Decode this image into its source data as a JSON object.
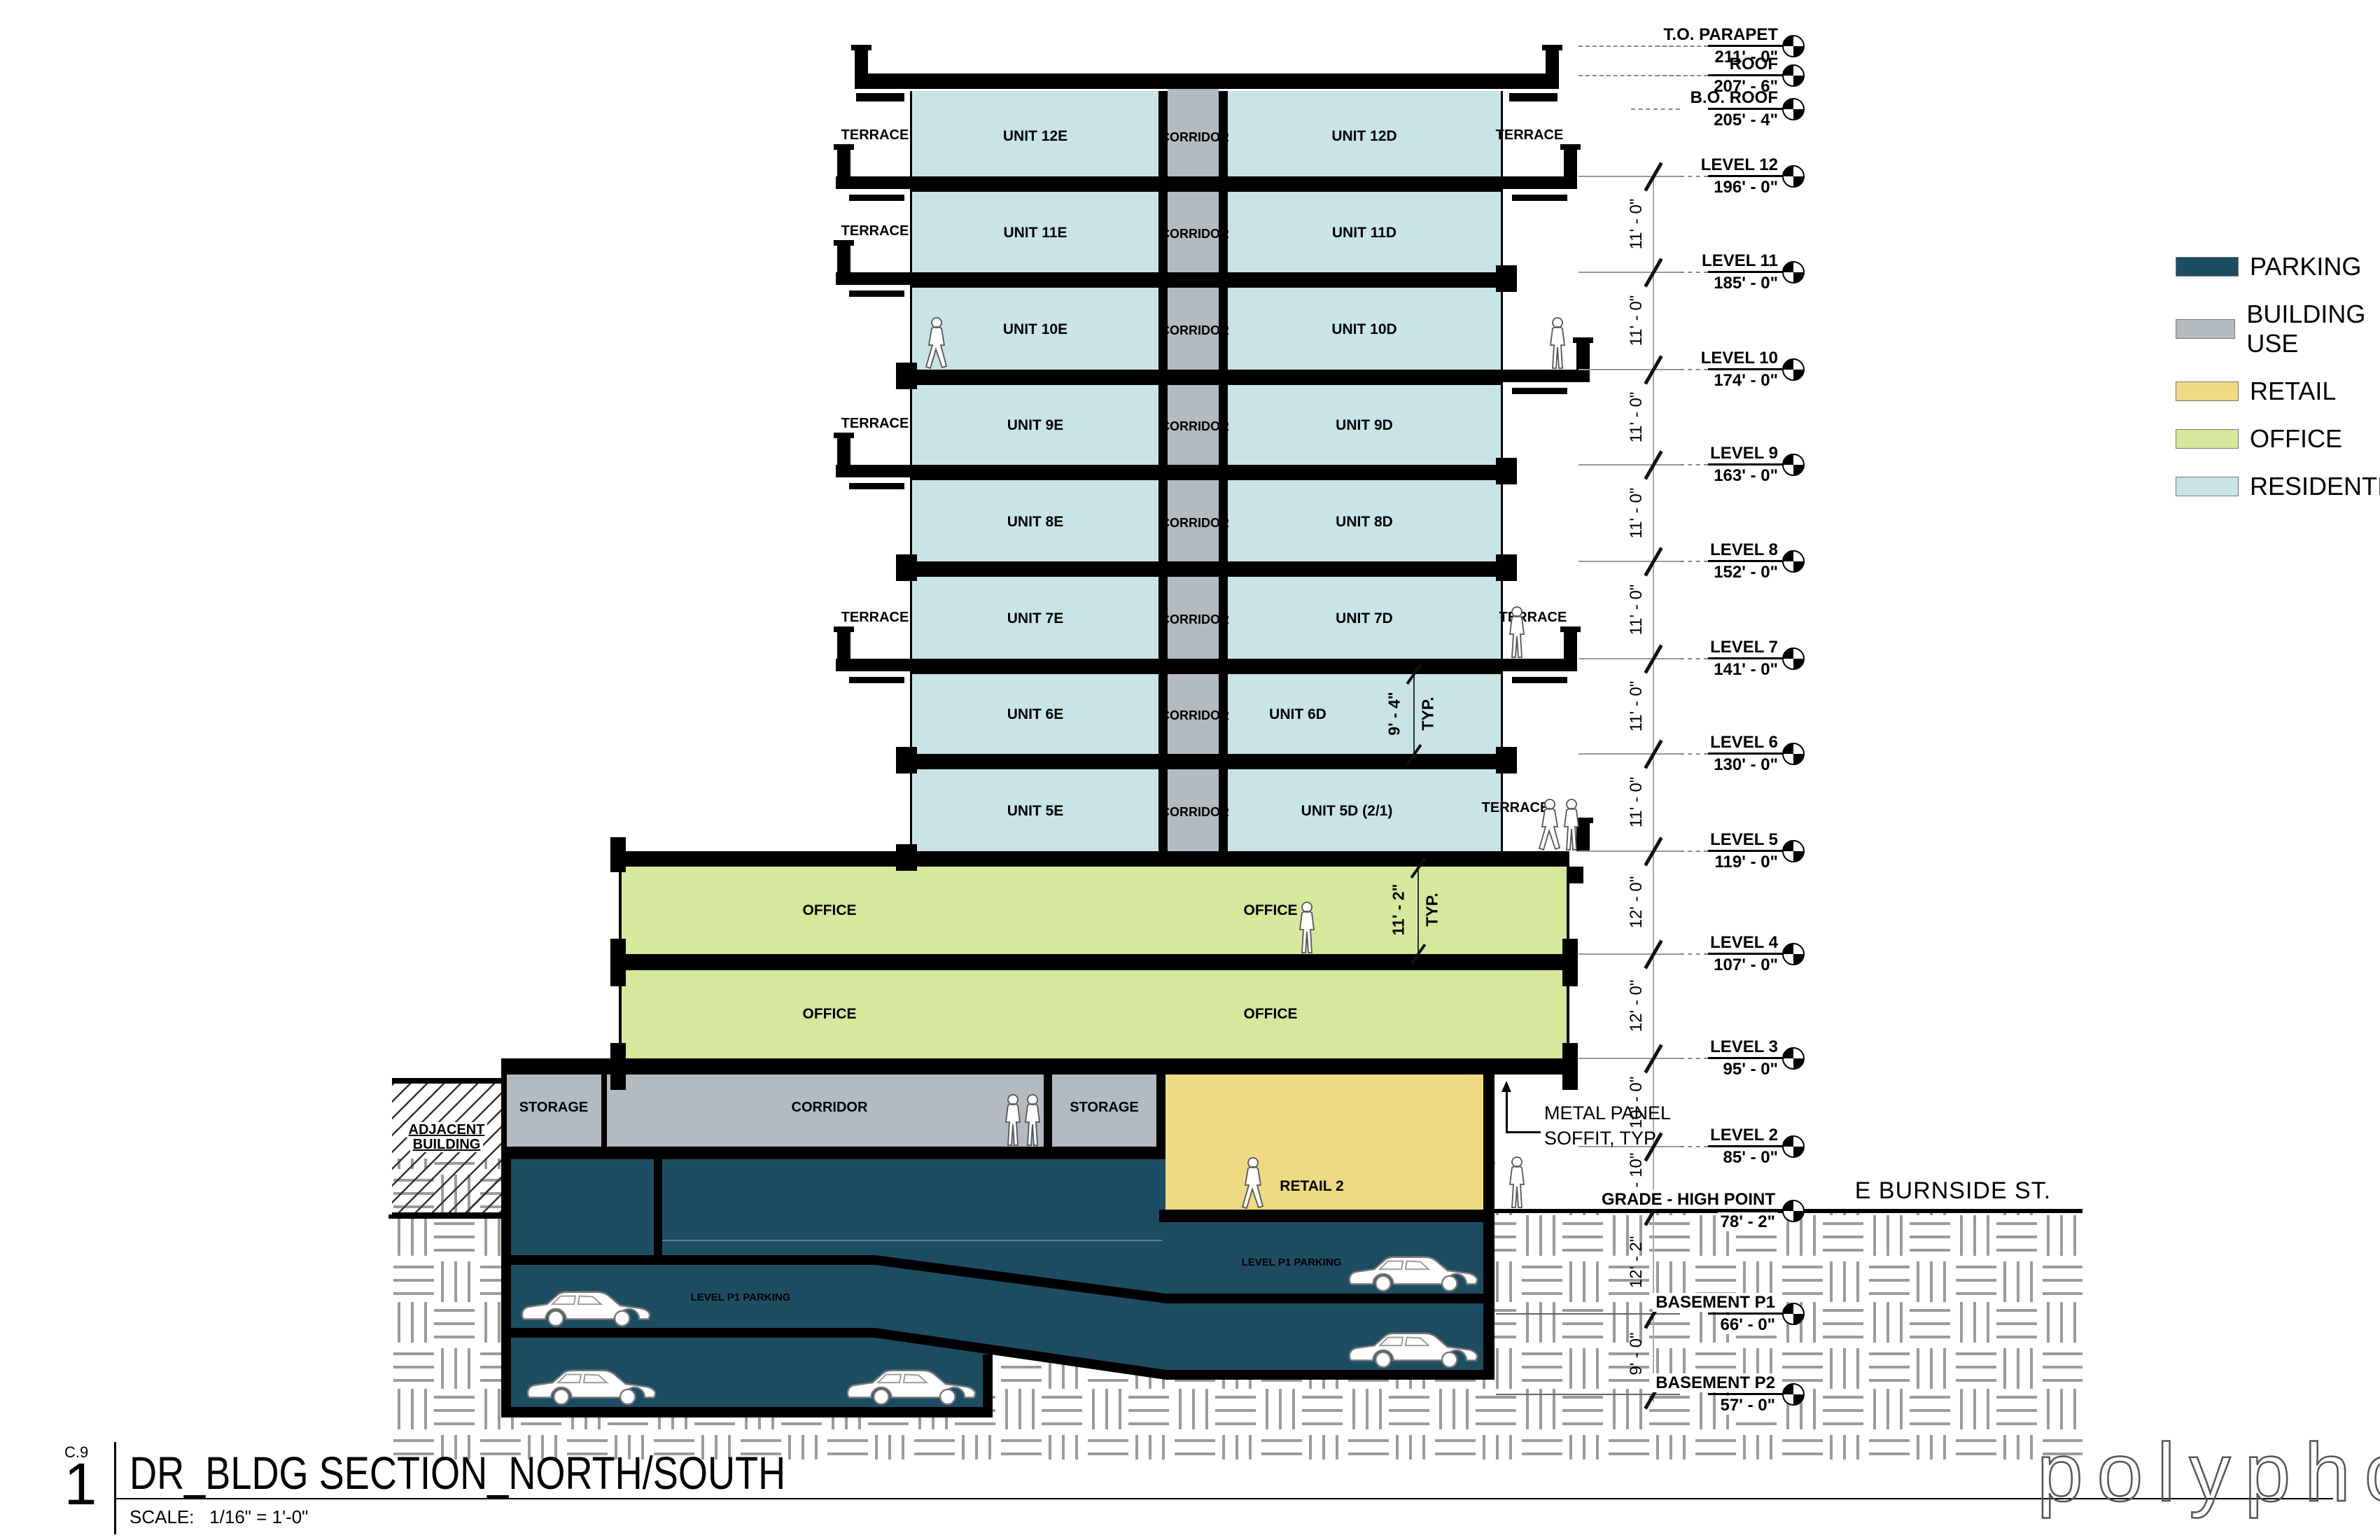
{
  "drawing": {
    "sheet_ref": "C.9",
    "detail_number": "1",
    "title": "DR_BLDG SECTION_NORTH/SOUTH",
    "scale_label": "SCALE:",
    "scale_value": "1/16\" = 1'-0\"",
    "logo": "polyphon"
  },
  "street": {
    "name": "E BURNSIDE ST."
  },
  "adjacent_building": {
    "line1": "ADJACENT",
    "line2": "BUILDING"
  },
  "legend": {
    "items": [
      {
        "label": "PARKING",
        "color": "#1d4d63"
      },
      {
        "label": "BUILDING USE",
        "color": "#b3bac0"
      },
      {
        "label": "RETAIL",
        "color": "#eeda82"
      },
      {
        "label": "OFFICE",
        "color": "#d7e79b"
      },
      {
        "label": "RESIDENTIAL",
        "color": "#c8e4e6"
      }
    ]
  },
  "levels": [
    {
      "name": "T.O. PARAPET",
      "elev": "211' - 0\""
    },
    {
      "name": "ROOF",
      "elev": "207' - 6\""
    },
    {
      "name": "B.O. ROOF",
      "elev": "205' - 4\""
    },
    {
      "name": "LEVEL 12",
      "elev": "196' - 0\""
    },
    {
      "name": "LEVEL 11",
      "elev": "185' - 0\""
    },
    {
      "name": "LEVEL 10",
      "elev": "174' - 0\""
    },
    {
      "name": "LEVEL 9",
      "elev": "163' - 0\""
    },
    {
      "name": "LEVEL 8",
      "elev": "152' - 0\""
    },
    {
      "name": "LEVEL 7",
      "elev": "141' - 0\""
    },
    {
      "name": "LEVEL 6",
      "elev": "130' - 0\""
    },
    {
      "name": "LEVEL 5",
      "elev": "119' - 0\""
    },
    {
      "name": "LEVEL 4",
      "elev": "107' - 0\""
    },
    {
      "name": "LEVEL 3",
      "elev": "95' - 0\""
    },
    {
      "name": "LEVEL 2",
      "elev": "85' - 0\""
    },
    {
      "name": "GRADE - HIGH POINT",
      "elev": "78' - 2\""
    },
    {
      "name": "BASEMENT P1",
      "elev": "66' - 0\""
    },
    {
      "name": "BASEMENT P2",
      "elev": "57' - 0\""
    }
  ],
  "dim_spans": [
    {
      "label": "11' - 0\""
    },
    {
      "label": "11' - 0\""
    },
    {
      "label": "11' - 0\""
    },
    {
      "label": "11' - 0\""
    },
    {
      "label": "11' - 0\""
    },
    {
      "label": "11' - 0\""
    },
    {
      "label": "11' - 0\""
    },
    {
      "label": "12' - 0\""
    },
    {
      "label": "12' - 0\""
    },
    {
      "label": "10' - 0\""
    },
    {
      "label": "6' - 10\""
    },
    {
      "label": "12' - 2\""
    },
    {
      "label": "9' - 0\""
    }
  ],
  "floors": [
    {
      "unit_e": "UNIT 12E",
      "corridor": "CORRIDOR",
      "unit_d": "UNIT 12D"
    },
    {
      "unit_e": "UNIT 11E",
      "corridor": "CORRIDOR",
      "unit_d": "UNIT 11D"
    },
    {
      "unit_e": "UNIT 10E",
      "corridor": "CORRIDOR",
      "unit_d": "UNIT 10D"
    },
    {
      "unit_e": "UNIT 9E",
      "corridor": "CORRIDOR",
      "unit_d": "UNIT 9D"
    },
    {
      "unit_e": "UNIT 8E",
      "corridor": "CORRIDOR",
      "unit_d": "UNIT 8D"
    },
    {
      "unit_e": "UNIT 7E",
      "corridor": "CORRIDOR",
      "unit_d": "UNIT 7D"
    },
    {
      "unit_e": "UNIT 6E",
      "corridor": "CORRIDOR",
      "unit_d": "UNIT 6D"
    },
    {
      "unit_e": "UNIT 5E",
      "corridor": "CORRIDOR",
      "unit_d": "UNIT 5D (2/1)"
    }
  ],
  "labels": {
    "terrace": "TERRACE",
    "office": "OFFICE",
    "storage": "STORAGE",
    "ground_corridor": "CORRIDOR",
    "retail": "RETAIL 2",
    "level_p1": "LEVEL P1 PARKING"
  },
  "annotations": {
    "soffit_line1": "METAL PANEL",
    "soffit_line2": "SOFFIT, TYP",
    "unit_clear_height": "9' - 4\"",
    "office_clear_height": "11' - 2\"",
    "typ": "TYP."
  },
  "icons": {
    "person-icon": "white human silhouette",
    "car-icon": "white sedan silhouette",
    "level-marker-icon": "quadrant circle level head"
  },
  "colors": {
    "parking": "#1d4d63",
    "building_use": "#b3bac0",
    "retail": "#eeda82",
    "office": "#d7e79b",
    "residential": "#c8e4e6",
    "slab": "#000000",
    "hatch": "#9b9b9b"
  }
}
